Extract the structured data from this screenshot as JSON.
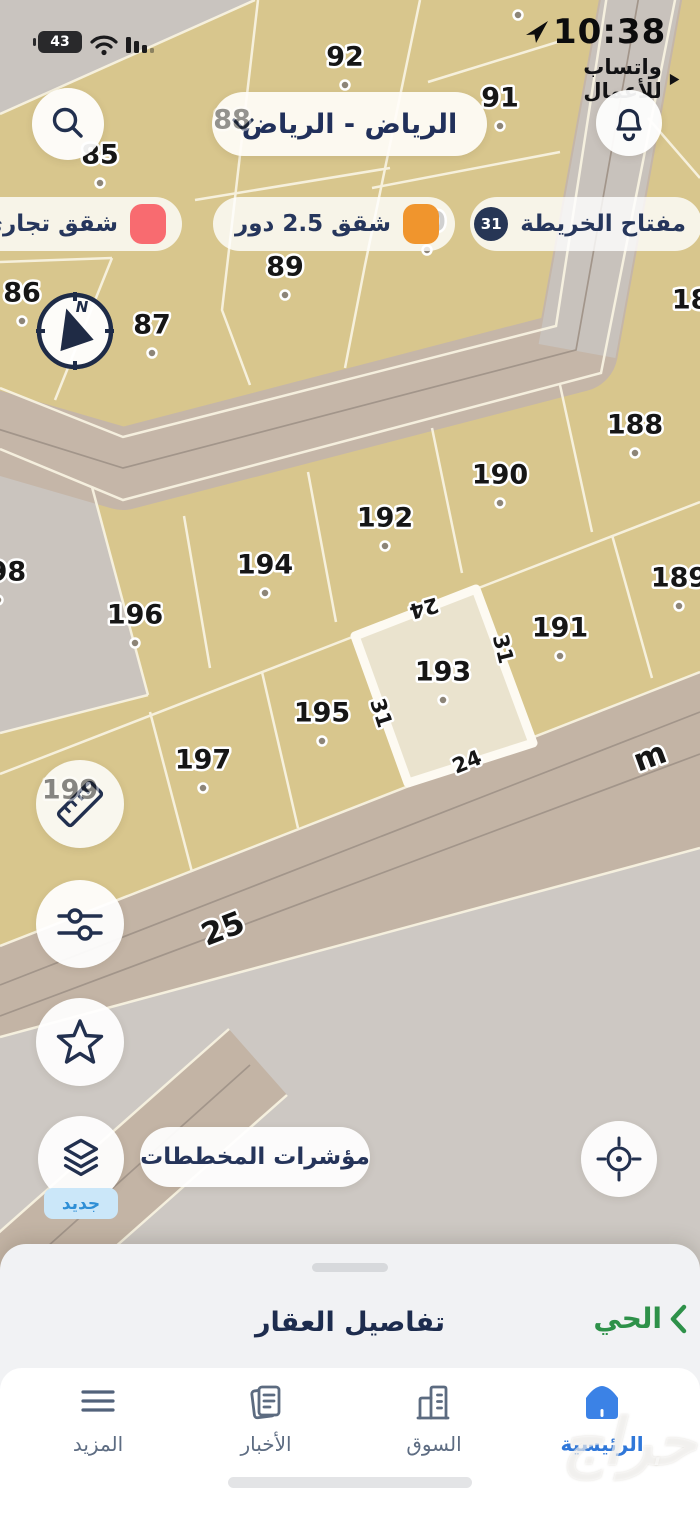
{
  "status_bar": {
    "battery": "43",
    "time": "10:38",
    "app_label": "واتساب للأعمال"
  },
  "header": {
    "location": "الرياض - الرياض"
  },
  "legend": {
    "title": "مفتاح الخريطة",
    "badge": "31",
    "items": [
      {
        "label": "شقق 2.5 دور",
        "color": "#f0952d"
      },
      {
        "label": "شقق تجاري",
        "color": "#f86b70"
      }
    ]
  },
  "map": {
    "highlight_parcel": "193",
    "colors": {
      "parcel": "#d8c68d",
      "road": "#c4b5a6",
      "road_gray": "#c8c2bc",
      "area_gray": "#cbc6c1",
      "highlight": "#eae3ce",
      "line": "#f8f3e1"
    },
    "parcels": [
      {
        "t": "85",
        "x": 100,
        "y": 155
      },
      {
        "t": "86",
        "x": 22,
        "y": 293
      },
      {
        "t": "87",
        "x": 152,
        "y": 325
      },
      {
        "t": "88",
        "x": 232,
        "y": 120,
        "layer": "top",
        "o": 0.45
      },
      {
        "t": "89",
        "x": 285,
        "y": 267
      },
      {
        "t": "90",
        "x": 427,
        "y": 222
      },
      {
        "t": "91",
        "x": 500,
        "y": 98
      },
      {
        "t": "92",
        "x": 345,
        "y": 57
      },
      {
        "t": "93",
        "x": 518,
        "y": -13
      },
      {
        "t": "185",
        "x": 700,
        "y": 300,
        "nd": true
      },
      {
        "t": "188",
        "x": 635,
        "y": 425
      },
      {
        "t": "189",
        "x": 679,
        "y": 578
      },
      {
        "t": "190",
        "x": 500,
        "y": 475
      },
      {
        "t": "191",
        "x": 560,
        "y": 628
      },
      {
        "t": "192",
        "x": 385,
        "y": 518
      },
      {
        "t": "193",
        "x": 443,
        "y": 672
      },
      {
        "t": "194",
        "x": 265,
        "y": 565
      },
      {
        "t": "195",
        "x": 322,
        "y": 713
      },
      {
        "t": "196",
        "x": 135,
        "y": 615
      },
      {
        "t": "197",
        "x": 203,
        "y": 760
      },
      {
        "t": "198",
        "x": -2,
        "y": 572
      },
      {
        "t": "199",
        "x": 70,
        "y": 790,
        "layer": "top",
        "o": 0.5
      }
    ],
    "dimensions": [
      {
        "t": "24",
        "x": 424,
        "y": 608,
        "r": 164
      },
      {
        "t": "31",
        "x": 503,
        "y": 649,
        "r": 76
      },
      {
        "t": "31",
        "x": 381,
        "y": 713,
        "r": 72
      },
      {
        "t": "24",
        "x": 467,
        "y": 762,
        "r": -22
      }
    ],
    "streets": [
      {
        "t": "25",
        "x": 223,
        "y": 929,
        "r": -21,
        "s": 31
      },
      {
        "t": "m",
        "x": 650,
        "y": 757,
        "r": -20,
        "s": 31
      }
    ]
  },
  "controls": {
    "plan_indicators": "مؤشرات المخططات",
    "new_badge": "جديد"
  },
  "sheet": {
    "title": "تفاصيل العقار",
    "district_link": "الحي"
  },
  "nav": {
    "items": [
      {
        "label": "الرئيسية"
      },
      {
        "label": "السوق"
      },
      {
        "label": "الأخبار"
      },
      {
        "label": "المزيد"
      }
    ],
    "active_index": 0
  },
  "watermark": "حراج"
}
